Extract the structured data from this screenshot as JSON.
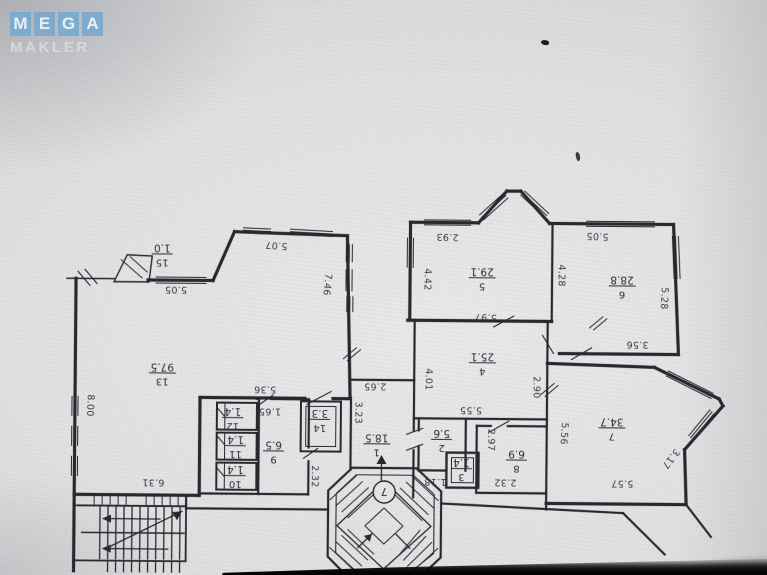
{
  "watermark": {
    "line1": "MEGA",
    "letters": [
      "M",
      "E",
      "G",
      "A"
    ],
    "line2": "MAKLER",
    "tile_color": "#79abd0",
    "letter_color": "#eff4f8",
    "line2_color": "#d9dcdf"
  },
  "plan": {
    "type": "apartment-floor-plan-photo-upside-down",
    "ink_color": "#2c2c31",
    "paper_color": "#e2e3e5",
    "stair_badge": "7",
    "rooms": [
      {
        "number": "1",
        "area": "18.5",
        "x": 378,
        "y": 444
      },
      {
        "number": "2",
        "area": "5.6",
        "x": 443,
        "y": 439
      },
      {
        "number": "3",
        "area": "1.4",
        "x": 463,
        "y": 468
      },
      {
        "number": "4",
        "area": "25.1",
        "x": 483,
        "y": 362
      },
      {
        "number": "5",
        "area": "29.1",
        "x": 482,
        "y": 277
      },
      {
        "number": "6",
        "area": "28.8",
        "x": 622,
        "y": 284
      },
      {
        "number": "7",
        "area": "34.7",
        "x": 613,
        "y": 426
      },
      {
        "number": "8",
        "area": "6.9",
        "x": 518,
        "y": 459
      },
      {
        "number": "9",
        "area": "6.5",
        "x": 275,
        "y": 452
      },
      {
        "number": "10",
        "area": "1.4",
        "x": 237,
        "y": 477
      },
      {
        "number": "11",
        "area": "1.4",
        "x": 237,
        "y": 447
      },
      {
        "number": "12",
        "area": "1.4",
        "x": 234,
        "y": 419
      },
      {
        "number": "13",
        "area": "97.5",
        "x": 163,
        "y": 375
      },
      {
        "number": "14",
        "area": "3.3",
        "x": 321,
        "y": 420
      },
      {
        "number": "15",
        "area": "1.0",
        "x": 162,
        "y": 256
      }
    ],
    "dimensions": [
      {
        "text": "5.07",
        "x": 276,
        "y": 246,
        "rot": 183
      },
      {
        "text": "5.05",
        "x": 176,
        "y": 291,
        "rot": 180
      },
      {
        "text": "2.93",
        "x": 447,
        "y": 236,
        "rot": 181
      },
      {
        "text": "5.05",
        "x": 597,
        "y": 234,
        "rot": 182
      },
      {
        "text": "8.00",
        "x": 91,
        "y": 408,
        "rot": 92
      },
      {
        "text": "7.46",
        "x": 327,
        "y": 285,
        "rot": 96
      },
      {
        "text": "4.42",
        "x": 427,
        "y": 279,
        "rot": 90
      },
      {
        "text": "4.28",
        "x": 561,
        "y": 274,
        "rot": 90
      },
      {
        "text": "5.28",
        "x": 664,
        "y": 296,
        "rot": 92
      },
      {
        "text": "5.97",
        "x": 486,
        "y": 316,
        "rot": 182
      },
      {
        "text": "3.56",
        "x": 638,
        "y": 342,
        "rot": 180
      },
      {
        "text": "5.36",
        "x": 266,
        "y": 390,
        "rot": 180
      },
      {
        "text": "2.65",
        "x": 376,
        "y": 386,
        "rot": 180
      },
      {
        "text": "1.65",
        "x": 271,
        "y": 412,
        "rot": 180
      },
      {
        "text": "3.23",
        "x": 359,
        "y": 413,
        "rot": 90
      },
      {
        "text": "4.01",
        "x": 429,
        "y": 379,
        "rot": 90
      },
      {
        "text": "5.55",
        "x": 472,
        "y": 409,
        "rot": 180
      },
      {
        "text": "2.90",
        "x": 537,
        "y": 386,
        "rot": 90
      },
      {
        "text": "5.56",
        "x": 565,
        "y": 432,
        "rot": 93
      },
      {
        "text": "3.17",
        "x": 672,
        "y": 456,
        "rot": 127
      },
      {
        "text": "2.97",
        "x": 492,
        "y": 439,
        "rot": 90
      },
      {
        "text": "1.18",
        "x": 437,
        "y": 481,
        "rot": 180
      },
      {
        "text": "2.32",
        "x": 507,
        "y": 481,
        "rot": 180
      },
      {
        "text": "2.32",
        "x": 316,
        "y": 477,
        "rot": 90
      },
      {
        "text": "5.57",
        "x": 624,
        "y": 481,
        "rot": 180
      },
      {
        "text": "6.31",
        "x": 155,
        "y": 484,
        "rot": 180
      }
    ]
  }
}
